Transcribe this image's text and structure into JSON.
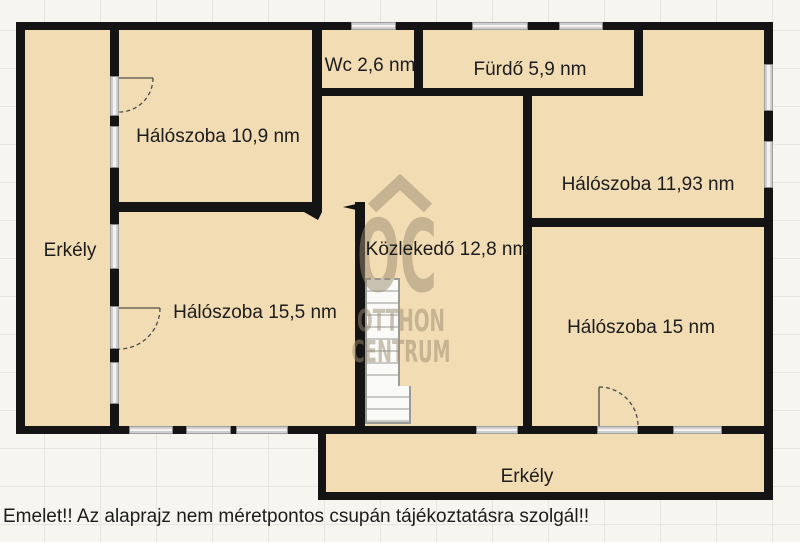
{
  "rooms": {
    "halo109": {
      "label": "Hálószoba 10,9 nm",
      "area_nm": "10,9"
    },
    "wc": {
      "label": "Wc 2,6 nm",
      "area_nm": "2,6"
    },
    "furdo": {
      "label": "Fürdő 5,9 nm",
      "area_nm": "5,9"
    },
    "halo1193": {
      "label": "Hálószoba 11,93 nm",
      "area_nm": "11,93"
    },
    "erkely_left": {
      "label": "Erkély"
    },
    "kozlekedo": {
      "label": "Közlekedő 12,8 nm",
      "area_nm": "12,8"
    },
    "halo155": {
      "label": "Hálószoba 15,5 nm",
      "area_nm": "15,5"
    },
    "halo15": {
      "label": "Hálószoba 15 nm",
      "area_nm": "15"
    },
    "erkely_bottom": {
      "label": "Erkély"
    }
  },
  "watermark": {
    "logo": "OC",
    "line1": "OTTHON",
    "line2": "CENTRUM"
  },
  "caption": "Emelet!! Az alaprajz nem méretpontos csupán tájékoztatásra szolgál!!",
  "colors": {
    "room-fill": "#f1dcb3",
    "wall": "#141414",
    "bg": "#f6f5f0",
    "grid": "#e8e6df",
    "text": "#1c1c1c",
    "watermark": "#9a8c70"
  }
}
